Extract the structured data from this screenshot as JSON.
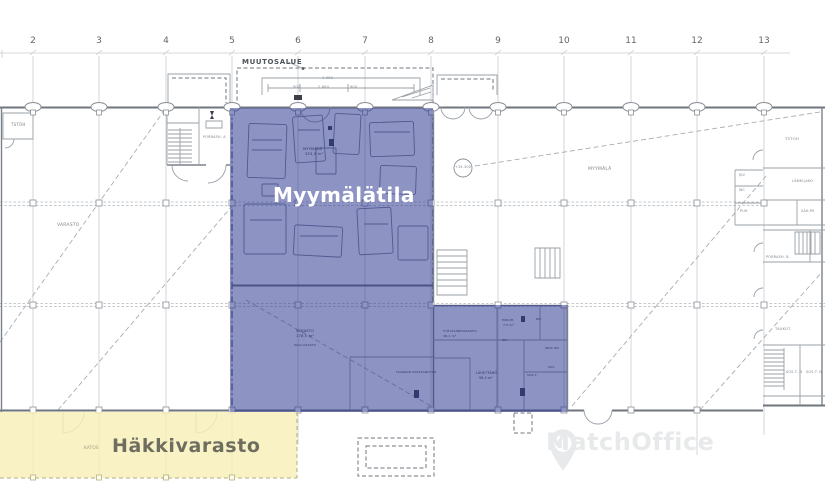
{
  "areas": {
    "shop": {
      "label": "Myymälätila",
      "overlay_color": "rgba(45,55,145,0.54)",
      "label_color": "#ffffff"
    },
    "storage": {
      "label": "Häkkivarasto",
      "overlay_color": "rgba(247,240,187,0.85)",
      "label_color": "#6e6e60"
    }
  },
  "annotations": {
    "change_area": "MUUTOSALUE",
    "level_mark": "+34.300"
  },
  "watermark": {
    "text": "MatchOffice",
    "icon": "map-pin-building-icon",
    "color": "#e7e9eb"
  },
  "grid_columns": [
    {
      "label": "2",
      "x": 33
    },
    {
      "label": "3",
      "x": 99
    },
    {
      "label": "4",
      "x": 166
    },
    {
      "label": "5",
      "x": 232
    },
    {
      "label": "6",
      "x": 298
    },
    {
      "label": "7",
      "x": 365
    },
    {
      "label": "8",
      "x": 431
    },
    {
      "label": "9",
      "x": 498
    },
    {
      "label": "10",
      "x": 564
    },
    {
      "label": "11",
      "x": 631
    },
    {
      "label": "12",
      "x": 697
    },
    {
      "label": "13",
      "x": 764
    }
  ],
  "plan_labels_under": [
    {
      "text": "VARASTO",
      "x": 57,
      "y": 224,
      "size": 4.5
    },
    {
      "text": "TSTOH",
      "x": 11,
      "y": 123,
      "size": 4
    },
    {
      "text": "PORRASH. A",
      "x": 203,
      "y": 136,
      "size": 3.4
    },
    {
      "text": "MYYMÄLÄ",
      "x": 588,
      "y": 168,
      "size": 4.5
    },
    {
      "text": "+34.300",
      "x": 455,
      "y": 166,
      "size": 3.4,
      "name": "level-annotation"
    },
    {
      "text": "4 000",
      "x": 322,
      "y": 77,
      "size": 3.5
    },
    {
      "text": "900",
      "x": 293,
      "y": 86,
      "size": 3.5
    },
    {
      "text": "2 800",
      "x": 318,
      "y": 86,
      "size": 3.5
    },
    {
      "text": "900",
      "x": 350,
      "y": 86,
      "size": 3.5
    },
    {
      "text": "TSTOH",
      "x": 785,
      "y": 137,
      "size": 3.8
    },
    {
      "text": "JKV",
      "x": 739,
      "y": 174,
      "size": 3.4
    },
    {
      "text": "LÄMM.JAKO",
      "x": 792,
      "y": 180,
      "size": 3.4
    },
    {
      "text": "WC",
      "x": 739,
      "y": 189,
      "size": 3.4
    },
    {
      "text": "PUH",
      "x": 740,
      "y": 210,
      "size": 3.4
    },
    {
      "text": "SÄH.PK",
      "x": 801,
      "y": 210,
      "size": 3.4
    },
    {
      "text": "PORRASH. B",
      "x": 766,
      "y": 256,
      "size": 3.4
    },
    {
      "text": "TAUKOT.",
      "x": 775,
      "y": 328,
      "size": 3.6
    },
    {
      "text": "SOS.T. M",
      "x": 786,
      "y": 371,
      "size": 3.4
    },
    {
      "text": "SOS.T. N",
      "x": 806,
      "y": 371,
      "size": 3.4
    }
  ],
  "plan_labels_over": [
    {
      "text": "KATOS",
      "x": 84,
      "y": 446,
      "size": 4.2,
      "color": "#a09c7e",
      "name": "katos-label"
    },
    {
      "text": "MYYMÄLÄ",
      "x": 303,
      "y": 148,
      "size": 3.6,
      "color": "#2e355c"
    },
    {
      "text": "353,3 m²",
      "x": 305,
      "y": 153,
      "size": 3.6,
      "color": "#2e355c"
    },
    {
      "text": "VARASTO",
      "x": 296,
      "y": 330,
      "size": 3.6,
      "color": "#2e355c"
    },
    {
      "text": "178,5 m²",
      "x": 296,
      "y": 335,
      "size": 3.6,
      "color": "#2e355c"
    },
    {
      "text": "PALO-OSASTO",
      "x": 294,
      "y": 344,
      "size": 2.8,
      "color": "#2e355c"
    },
    {
      "text": "TYÖVÄLINEVARASTO",
      "x": 443,
      "y": 330,
      "size": 3,
      "color": "#2e355c"
    },
    {
      "text": "38,1 m²",
      "x": 443,
      "y": 335,
      "size": 3,
      "color": "#2e355c"
    },
    {
      "text": "TAVARAN VASTAANOTTO",
      "x": 396,
      "y": 371,
      "size": 3,
      "color": "#2e355c"
    },
    {
      "text": "LÄHETTÄMÖ",
      "x": 476,
      "y": 372,
      "size": 3.2,
      "color": "#2e355c"
    },
    {
      "text": "98,0 m²",
      "x": 479,
      "y": 377,
      "size": 3.2,
      "color": "#2e355c"
    },
    {
      "text": "PUKUH.",
      "x": 502,
      "y": 319,
      "size": 3,
      "color": "#2e355c"
    },
    {
      "text": "7,5 m²",
      "x": 503,
      "y": 324,
      "size": 3,
      "color": "#2e355c"
    },
    {
      "text": "WC",
      "x": 536,
      "y": 318,
      "size": 3,
      "color": "#2e355c"
    },
    {
      "text": "WC",
      "x": 502,
      "y": 339,
      "size": 3,
      "color": "#2e355c"
    },
    {
      "text": "INVA WC",
      "x": 545,
      "y": 347,
      "size": 3,
      "color": "#2e355c"
    },
    {
      "text": "SIIV.",
      "x": 548,
      "y": 366,
      "size": 3,
      "color": "#2e355c"
    },
    {
      "text": "SOS.T.",
      "x": 527,
      "y": 374,
      "size": 3,
      "color": "#2e355c"
    }
  ]
}
